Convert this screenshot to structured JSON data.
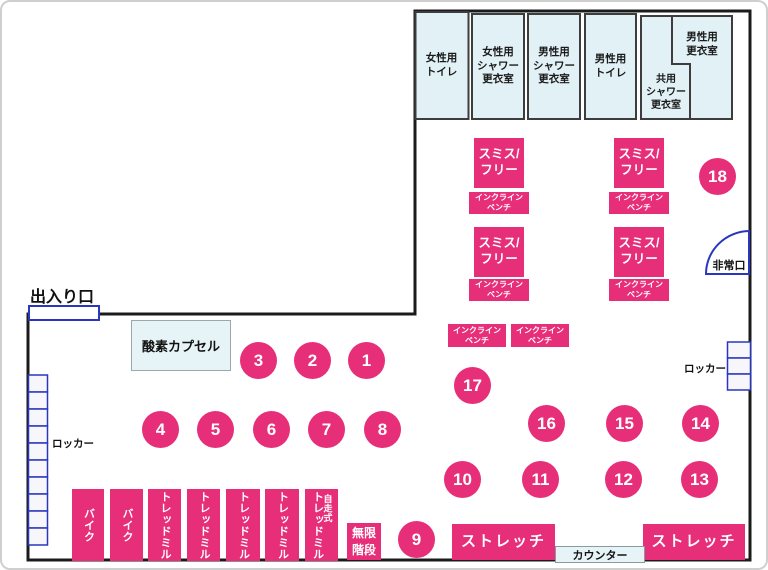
{
  "colors": {
    "pink": "#e72e78",
    "room_fill": "#e1f1f5",
    "room_border": "#3d3d3d",
    "blue": "#2a36bd",
    "wall": "#1b1b1b",
    "counter_fill": "#e7f4f7",
    "locker_fill": "#f6f6fb"
  },
  "rooms": [
    {
      "lines": [
        "女性用",
        "トイレ"
      ]
    },
    {
      "lines": [
        "女性用",
        "シャワー",
        "更衣室"
      ]
    },
    {
      "lines": [
        "男性用",
        "シャワー",
        "更衣室"
      ]
    },
    {
      "lines": [
        "男性用",
        "トイレ"
      ]
    },
    {
      "lines": [
        "共用",
        "シャワー",
        "更衣室"
      ]
    },
    {
      "lines": [
        "男性用",
        "更衣室"
      ]
    }
  ],
  "smith_free": {
    "line1": "スミス/",
    "line2": "フリー"
  },
  "incline_bench": {
    "line1": "インクライン",
    "line2": "ベンチ"
  },
  "entrance_label": "出入り口",
  "emergency_exit_label": "非常口",
  "oxygen_capsule_label": "酸素カプセル",
  "locker_label": "ロッカー",
  "infinite_stairs": {
    "line1": "無限",
    "line2": "階段"
  },
  "stretch_label": "ストレッチ",
  "counter_label": "カウンター",
  "equipment": [
    {
      "label": "バイク"
    },
    {
      "label": "バイク"
    },
    {
      "label": "トレッドミル"
    },
    {
      "label": "トレッドミル"
    },
    {
      "label": "トレッドミル"
    },
    {
      "label": "トレッドミル"
    },
    {
      "label": "トレッドミル",
      "sublabel": "自走式"
    }
  ],
  "circles": [
    "1",
    "2",
    "3",
    "4",
    "5",
    "6",
    "7",
    "8",
    "9",
    "10",
    "11",
    "12",
    "13",
    "14",
    "15",
    "16",
    "17",
    "18"
  ]
}
